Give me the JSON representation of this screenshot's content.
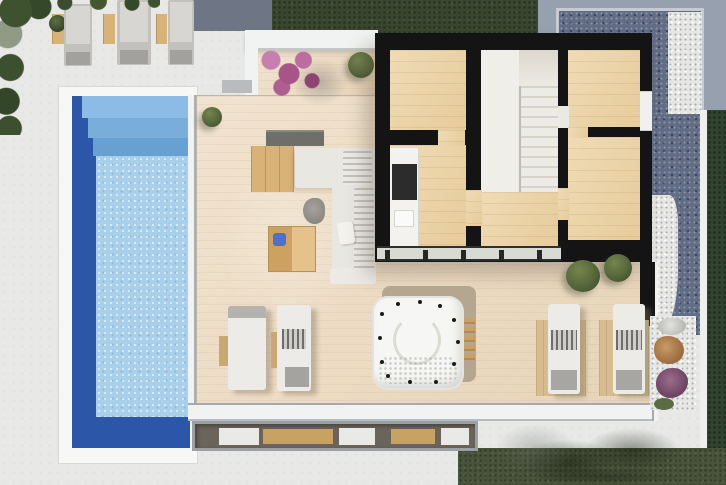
{
  "scene": {
    "type": "architectural-floor-plan-3d-render",
    "view": "top-down",
    "areas": [
      "lawn",
      "swimming-pool",
      "sun-deck",
      "wood-terrace",
      "house-interior",
      "gravel-garden"
    ],
    "rooms": [
      "bedroom-left",
      "kitchen",
      "stair-hall",
      "bedroom-top-right",
      "bedroom-right"
    ],
    "outdoor_items": [
      "sun-loungers",
      "outdoor-sofa",
      "coffee-table",
      "hot-tub",
      "bougainvillea",
      "bushes",
      "sunken-bench"
    ]
  },
  "palette": {
    "paving": "#e8e9e7",
    "lawn": "#47533a",
    "lawn_dark": "#3a4730",
    "pool_deep": "#2c57a9",
    "pool_step": "#79add9",
    "pool_water": "#a9cfea",
    "terrace_wood": "#eddbc2",
    "room_wood": "#ecd3a4",
    "wall_black": "#141414",
    "furniture_wood": "#d9b277",
    "counter_white": "#f3f2ef",
    "gravel_dark": "#616c85",
    "gravel_white": "#e6e7e4",
    "bush_olive": "#55663a",
    "bougainvillea_pink": "#b05e92",
    "accent_blue": "#4f6fd0",
    "lounger_gray": "#c3c1be",
    "tub_white": "#f6f6f4"
  }
}
